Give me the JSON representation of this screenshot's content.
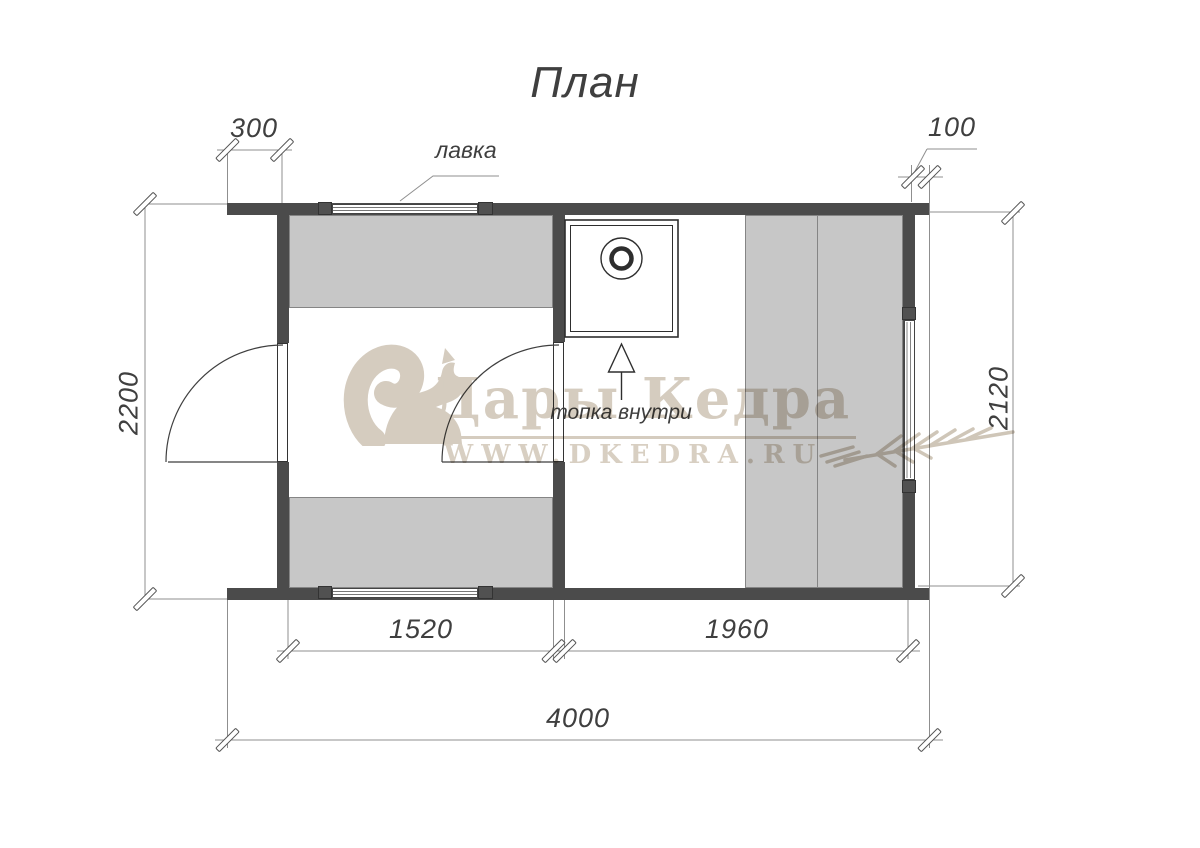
{
  "title": "План",
  "labels": {
    "bench": "лавка",
    "stove": "топка внутри"
  },
  "dims": {
    "porch": "300",
    "overhang": "100",
    "height_left": "2200",
    "height_right": "2120",
    "room_left": "1520",
    "room_right": "1960",
    "total": "4000"
  },
  "watermark": {
    "brand": "Дары Кедра",
    "site": "WWW.DKEDRA.RU"
  },
  "colors": {
    "wall": "#4b4b4b",
    "bench_fill": "#c7c7c7",
    "bench_border": "#858585",
    "line": "#8f8f8f",
    "draw": "#3f3f3f",
    "watermark": "#d5ccbf"
  }
}
